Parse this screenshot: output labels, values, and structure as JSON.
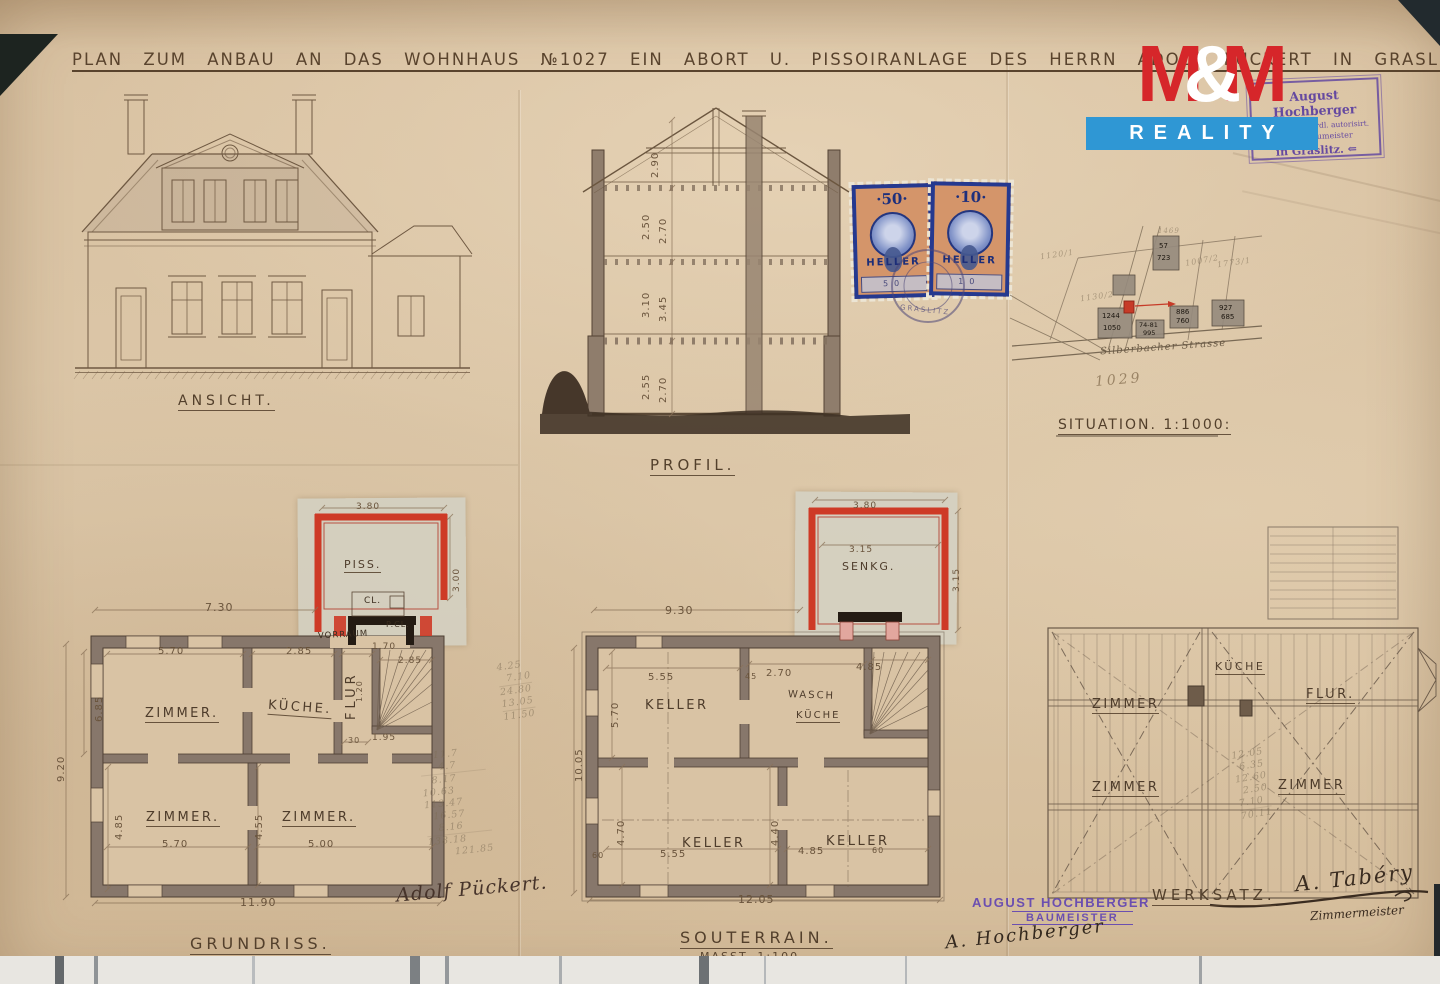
{
  "title": "PLAN ZUM ANBAU AN DAS WOHNHAUS №1027 EIN ABORT U. PISSOIRANLAGE DES HERRN ADOLF PÜCKERT IN GRASLITZ.",
  "watermark": {
    "m1": "M",
    "amp": "&",
    "m2": "M",
    "reality": "REALITY"
  },
  "auth_stamp": {
    "l1": "August Hochberger",
    "l2": "geprüft., behördl. autorisirt.",
    "l3": "beeid. Baumeister",
    "l4": "in Graslitz. ⇐"
  },
  "revenue": {
    "left_value": "·50·",
    "right_value": "·10·",
    "left_num": "50",
    "right_num": "10",
    "unit": "HELLER",
    "postmark": "GRASLITZ"
  },
  "ansicht": {
    "label": "ANSICHT."
  },
  "profil": {
    "label": "PROFIL.",
    "d1": "2.90",
    "d2": "2.50",
    "d3": "2.70",
    "d4": "3.10",
    "d5": "3.45",
    "d6": "2.55",
    "d7": "2.70"
  },
  "situation": {
    "label": "SITUATION. 1:1000:",
    "street": "Silberbacher Strasse",
    "plot": "1029",
    "p1": "1130/2",
    "p2": "1120/1",
    "p3": "1007/2",
    "p4": "1773/1",
    "p5": "1469",
    "h1a": "1244",
    "h1b": "1050",
    "h2a": "74-81",
    "h2b": "995",
    "h3a": "886",
    "h3b": "760",
    "h4a": "927",
    "h4b": "685",
    "h5a": "57",
    "h5b": "723"
  },
  "grundriss": {
    "label": "GRUNDRISS.",
    "z1": "ZIMMER.",
    "k1": "KÜCHE.",
    "flur": "FLUR",
    "z2": "ZIMMER.",
    "z3": "ZIMMER.",
    "piss": "PISS.",
    "cl": "CL.",
    "pcl": "P.CL.",
    "vorraum": "VORRAUM",
    "d_add_w": "3.80",
    "d_add_h": "3.00",
    "d_top": "7.30",
    "d1": "5.70",
    "d2": "2.85",
    "d3": "1.70",
    "d4": "2.85",
    "d5": "1.20",
    "d6": "6.85",
    "d7": "9.20",
    "d8": "4.85",
    "d9": "4.55",
    "d10": "5.70",
    "d11": "5.00",
    "d12": "11.90",
    "d13": "1.95",
    "d14": "30",
    "calc1": [
      "4.25",
      "7.10",
      "24.80",
      "13.05",
      "11.50"
    ],
    "calc2": [
      "11.7",
      "4.7",
      "8.17",
      "10.63",
      "113.47",
      "16.57",
      "8.16",
      "138.18",
      "121.85"
    ]
  },
  "souterrain": {
    "label": "SOUTERRAIN.",
    "scale": "MASST. 1:100.",
    "k1": "KELLER",
    "wasch": "WASCH",
    "kueche": "KÜCHE",
    "k2": "KELLER",
    "k3": "KELLER",
    "senk": "SENKG.",
    "d_add_w": "3.80",
    "d_add_i": "3.15",
    "d_add_h": "3.15",
    "d_top": "9.30",
    "d1": "5.55",
    "d2": "2.70",
    "d3": "4.85",
    "d4": "10.05",
    "d5": "5.70",
    "d6": "4.70",
    "d7": "4.40",
    "d8": "5.55",
    "d9": "4.85",
    "d10": "12.05",
    "w1": "60",
    "w2": "60",
    "w3": "45",
    "calc": [
      "12.05",
      "6.35",
      "12.60",
      "2.50",
      "7.10",
      "70.11"
    ]
  },
  "werksatz": {
    "label": "WERKSATZ.",
    "kueche": "KÜCHE",
    "flur": "FLUR.",
    "z1": "ZIMMER",
    "z2": "ZIMMER",
    "z3": "ZIMMER"
  },
  "signatures": {
    "owner": "Adolf Pückert.",
    "stamp_name": "AUGUST HOCHBERGER",
    "stamp_title": "BAUMEISTER",
    "ink_mid": "A. Hochberger",
    "ink_right": "A. Tabéry",
    "ink_right_title": "Zimmermeister"
  }
}
